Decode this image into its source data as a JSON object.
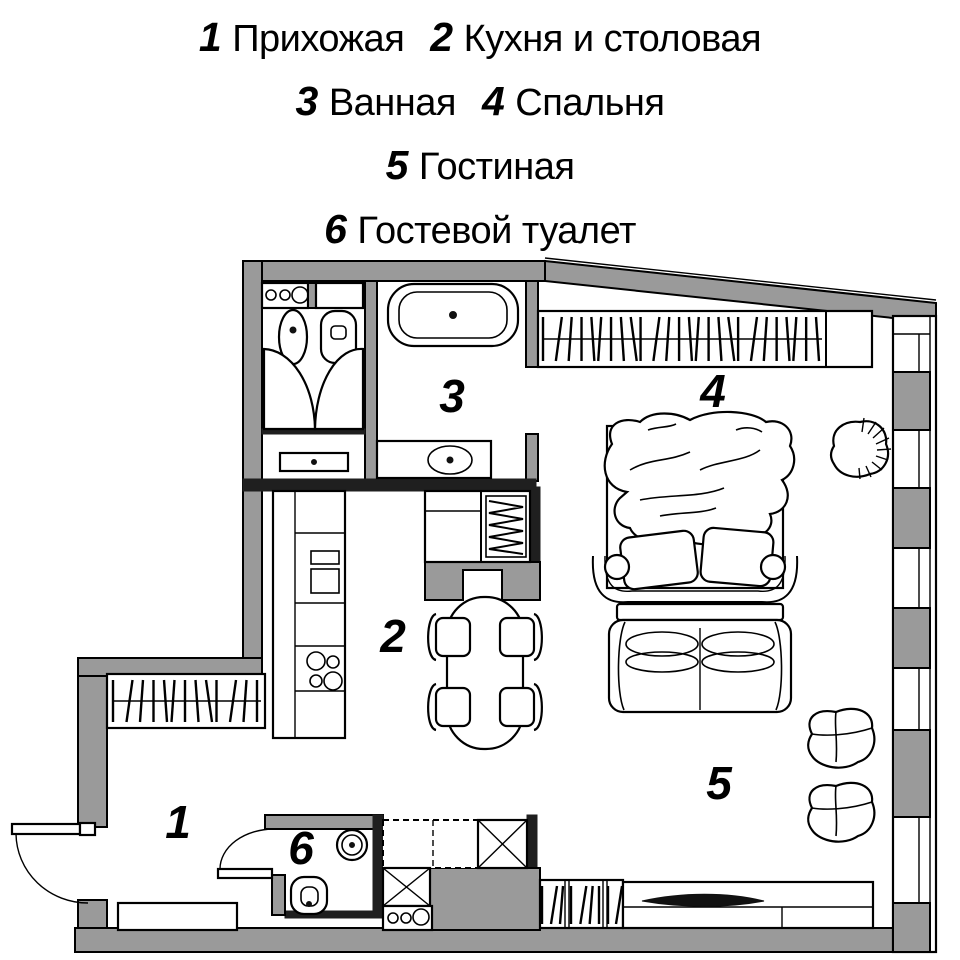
{
  "legend": {
    "lines": [
      {
        "items": [
          {
            "num": "1",
            "name": "Прихожая"
          },
          {
            "num": "2",
            "name": "Кухня и столовая"
          }
        ]
      },
      {
        "items": [
          {
            "num": "3",
            "name": "Ванная"
          },
          {
            "num": "4",
            "name": "Спальня"
          }
        ]
      },
      {
        "items": [
          {
            "num": "5",
            "name": "Гостиная"
          }
        ]
      },
      {
        "items": [
          {
            "num": "6",
            "name": "Гостевой туалет"
          }
        ]
      }
    ]
  },
  "plan": {
    "room_labels": [
      {
        "num": "1"
      },
      {
        "num": "2"
      },
      {
        "num": "3"
      },
      {
        "num": "4"
      },
      {
        "num": "5"
      },
      {
        "num": "6"
      }
    ],
    "colors": {
      "wall": "#9a9a9a",
      "line": "#000000",
      "dark": "#1f1f1f",
      "bg": "#ffffff"
    }
  }
}
